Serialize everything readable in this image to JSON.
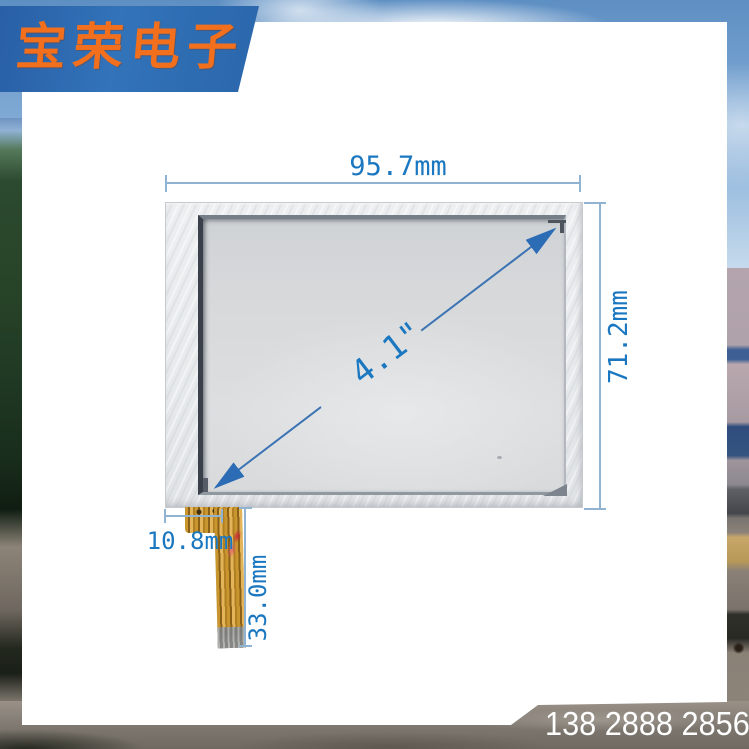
{
  "logo": {
    "text": "宝荣电子",
    "banner_color": "#2e6bb0",
    "text_color": "#f2701d"
  },
  "contact": {
    "phone": "138 2888 2856"
  },
  "dimensions": {
    "width": "95.7mm",
    "height": "71.2mm",
    "diagonal": "4.1\"",
    "cable_offset": "10.8mm",
    "cable_length": "33.0mm"
  },
  "colors": {
    "dimension_text": "#1b78c0",
    "dimension_line": "#8fb3d0",
    "arrow": "#2c6cb5",
    "card": "#ffffff",
    "cable_gold": "#c9952f"
  }
}
